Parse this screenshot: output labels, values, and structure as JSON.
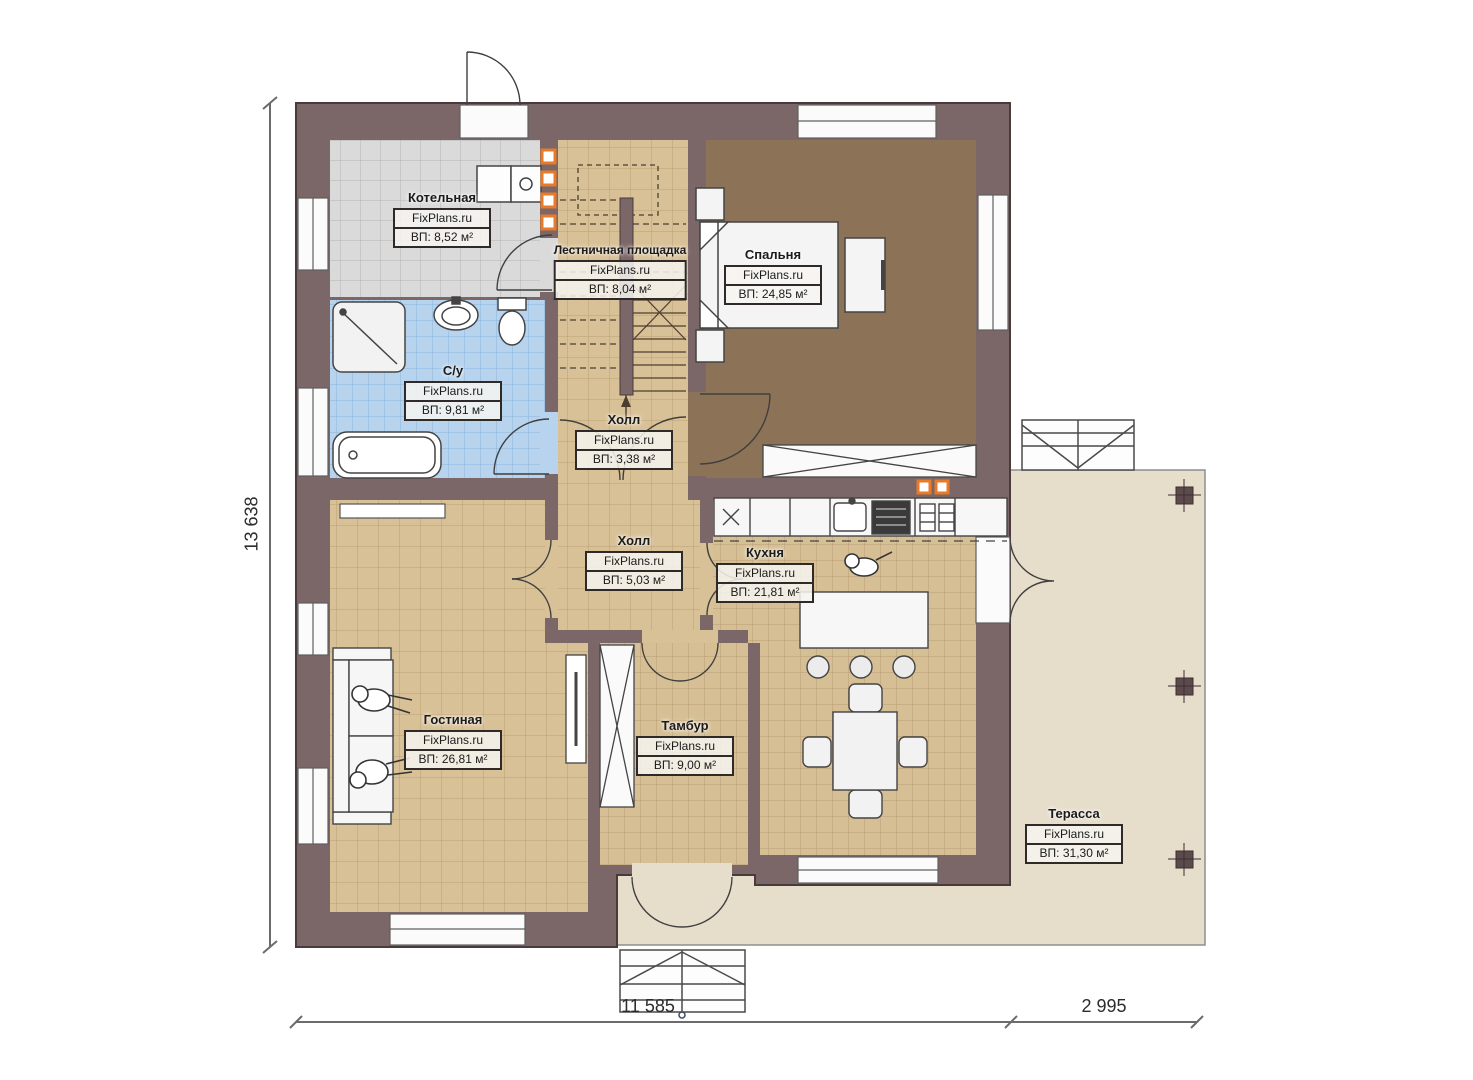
{
  "plan": {
    "site": "FixPlans.ru",
    "rooms": [
      {
        "name": "Котельная",
        "area": "ВП: 8,52 м²"
      },
      {
        "name": "Лестничная площадка",
        "area": "ВП: 8,04 м²"
      },
      {
        "name": "Спальня",
        "area": "ВП: 24,85 м²"
      },
      {
        "name": "С/у",
        "area": "ВП: 9,81 м²"
      },
      {
        "name": "Холл",
        "area": "ВП: 3,38 м²"
      },
      {
        "name": "Холл",
        "area": "ВП: 5,03 м²"
      },
      {
        "name": "Кухня",
        "area": "ВП: 21,81 м²"
      },
      {
        "name": "Гостиная",
        "area": "ВП: 26,81 м²"
      },
      {
        "name": "Тамбур",
        "area": "ВП: 9,00 м²"
      },
      {
        "name": "Терасса",
        "area": "ВП: 31,30 м²"
      }
    ],
    "dimensions": {
      "left": "13 638",
      "bottom": "11 585",
      "right": "2 995"
    },
    "colors": {
      "wall": "#7b6668",
      "floor_tile_tan": "#d8c197",
      "floor_tile_gray": "#dadada",
      "floor_tile_blue": "#b7d3ee",
      "floor_bedroom": "#8c7257",
      "terrace": "#e6ddcb",
      "accent_orange": "#e87a28"
    }
  }
}
